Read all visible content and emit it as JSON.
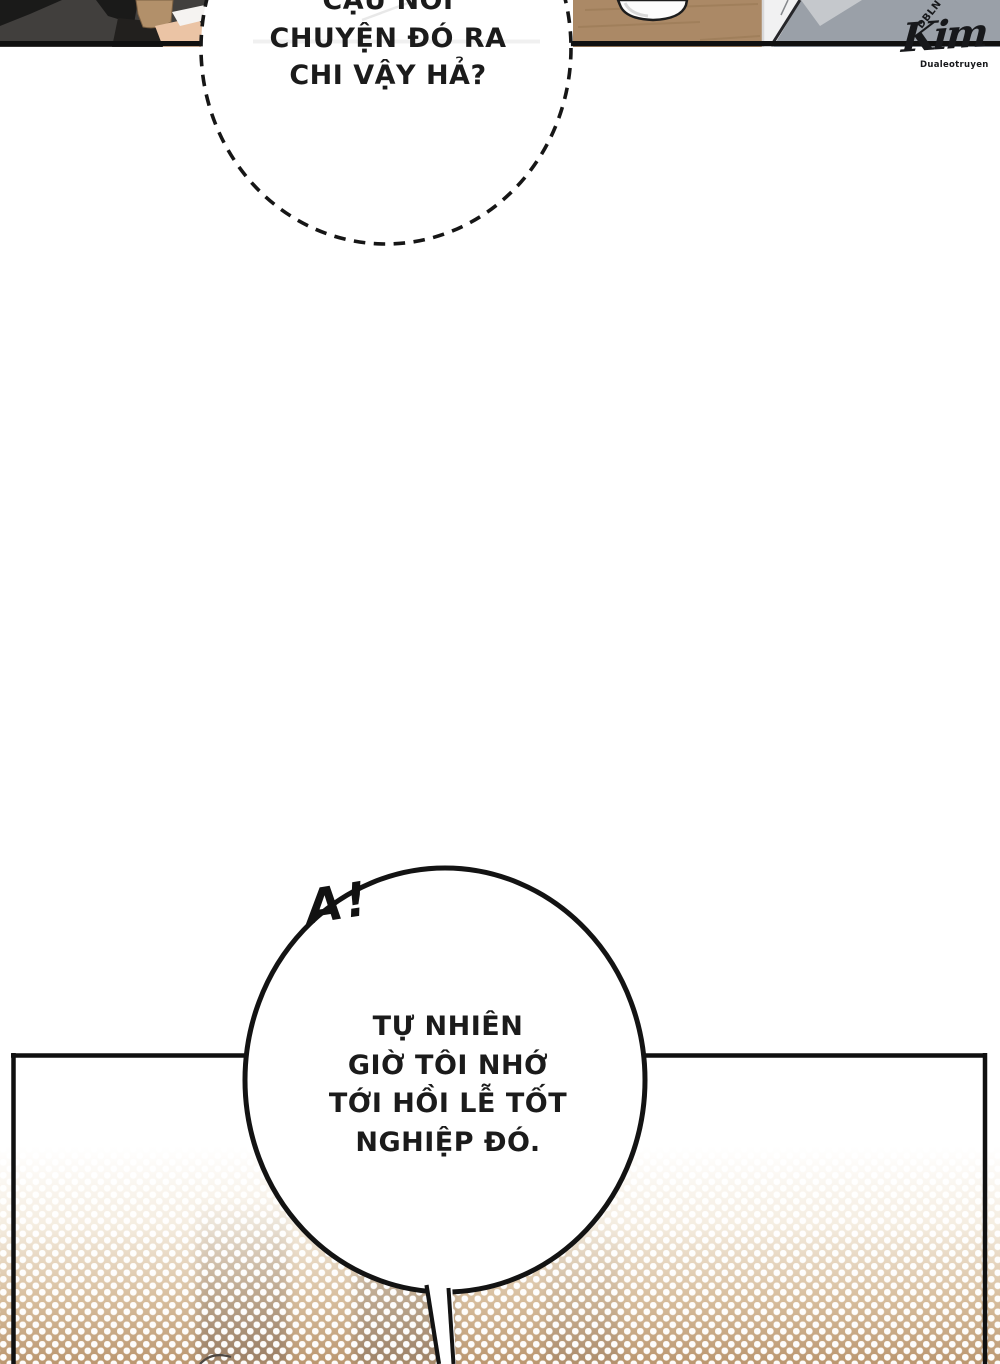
{
  "page": {
    "background": "#ffffff",
    "width": 1000,
    "height": 1364
  },
  "colors": {
    "ink": "#131313",
    "text": "#1b1b1b",
    "panel_border": "#101010",
    "jacket": "#413f3d",
    "lapel": "#1a1a19",
    "hair": "#b2906a",
    "hair_outline": "#7a5f42",
    "skin": "#ebc4a5",
    "collar": "#f5f3f1",
    "table_wood": "#ab8966",
    "wood_grain": "#93744f",
    "bowl": "#fcfcfc",
    "shirt": "#f1f1f2",
    "wall": "#9aa0a8",
    "wall_light": "#c7cacd",
    "bubble_fill": "#ffffff",
    "halftone_base": "#bb9770",
    "halftone_dot": "#ffffff"
  },
  "bubbles": {
    "whisper": {
      "style": "dashed",
      "lines": [
        "CẬU NÓI",
        "CHUYỆN ĐÓ RA",
        "CHI VẬY HẢ?"
      ]
    },
    "main": {
      "style": "solid",
      "lines": [
        "TỰ NHIÊN",
        "GIỜ TÔI NHỚ",
        "TỚI HỒI LỄ TỐT",
        "NGHIỆP ĐÓ."
      ]
    }
  },
  "sfx": {
    "exclamation": "A!"
  },
  "watermark": {
    "initials": "DBLN",
    "name": "Kim",
    "site": "Dualeotruyen"
  }
}
